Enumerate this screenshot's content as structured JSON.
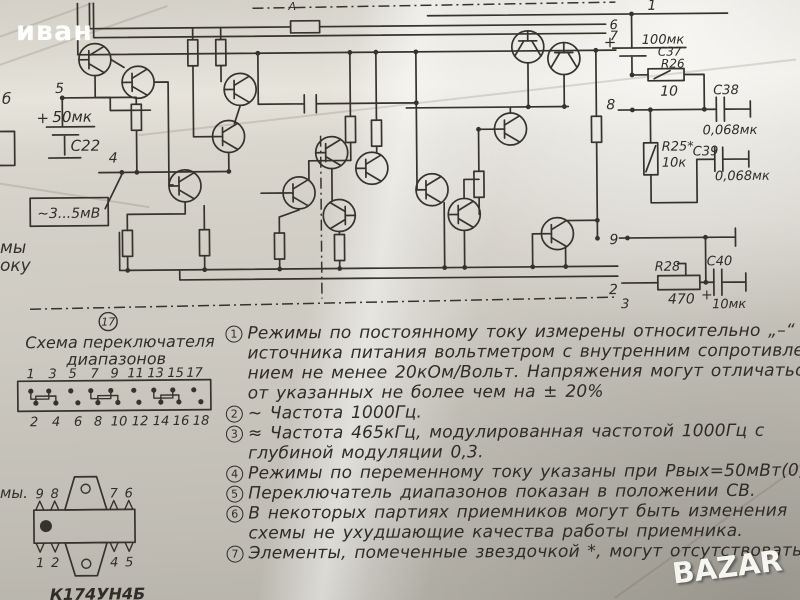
{
  "watermarks": {
    "top_left": "иван",
    "bottom_right": "BAZAR"
  },
  "fragments": {
    "left_top": "б",
    "left_mid1": "мы",
    "left_mid2": "оку",
    "left_chip": "мы.",
    "top_a": "А"
  },
  "schematic": {
    "pin1": "1",
    "pin2": "2",
    "pin3": "3",
    "pin4": "4",
    "pin5": "5",
    "pin6": "6",
    "pin7": "7",
    "pin8": "8",
    "pin9": "9",
    "c22_plus": "+",
    "c22_value": "50мк",
    "c22_name": "C22",
    "input_level": "~3...5мВ",
    "c37_plus": "+",
    "c37_value": "100мк",
    "c37_name": "C37",
    "r26_name": "R26",
    "r26_value": "10",
    "c38_name": "C38",
    "c38_value": "0,068мк",
    "r25_name": "R25*",
    "r25_value": "10к",
    "c39_name": "C39",
    "c39_value": "0,068мк",
    "r28_name": "R28",
    "r28_value": "470",
    "c40_name": "C40",
    "c40_plus": "+",
    "c40_value": "10мк"
  },
  "switch": {
    "number": "17",
    "title1": "Схема переключателя",
    "title2": "диапазонов",
    "top_pins": [
      "1",
      "3",
      "5",
      "7",
      "9",
      "11",
      "13",
      "15",
      "17"
    ],
    "bottom_pins": [
      "2",
      "4",
      "6",
      "8",
      "10",
      "12",
      "14",
      "16",
      "18"
    ]
  },
  "chip": {
    "name": "К174УН4Б",
    "pins_top_left": [
      "9",
      "8"
    ],
    "pins_top_right": [
      "7",
      "6"
    ],
    "pins_bottom_left": [
      "1",
      "2"
    ],
    "pins_bottom_right": [
      "4",
      "5"
    ]
  },
  "notes": [
    {
      "num": "1",
      "lines": [
        "Режимы по постоянному току измерены относительно „–“",
        "источника питания вольтметром с внутренним сопротивле-",
        "нием не менее 20кОм/Вольт. Напряжения могут отличаться",
        "от указанных не более чем на ± 20%"
      ]
    },
    {
      "num": "2",
      "lines": [
        "~ Частота 1000Гц."
      ]
    },
    {
      "num": "3",
      "lines": [
        "≈ Частота 465кГц, модулированная частотой 1000Гц с",
        "глубиной модуляции 0,3."
      ]
    },
    {
      "num": "4",
      "lines": [
        "Режимы по переменному току указаны при Рвых=50мВт(0,63В)"
      ]
    },
    {
      "num": "5",
      "lines": [
        "Переключатель диапазонов показан в положении СВ."
      ]
    },
    {
      "num": "6",
      "lines": [
        "В некоторых партиях приемников могут быть изменения",
        "схемы не ухудшающие качества работы приемника."
      ]
    },
    {
      "num": "7",
      "lines": [
        "Элементы, помеченные звездочкой *, могут отсутствовать"
      ]
    }
  ]
}
